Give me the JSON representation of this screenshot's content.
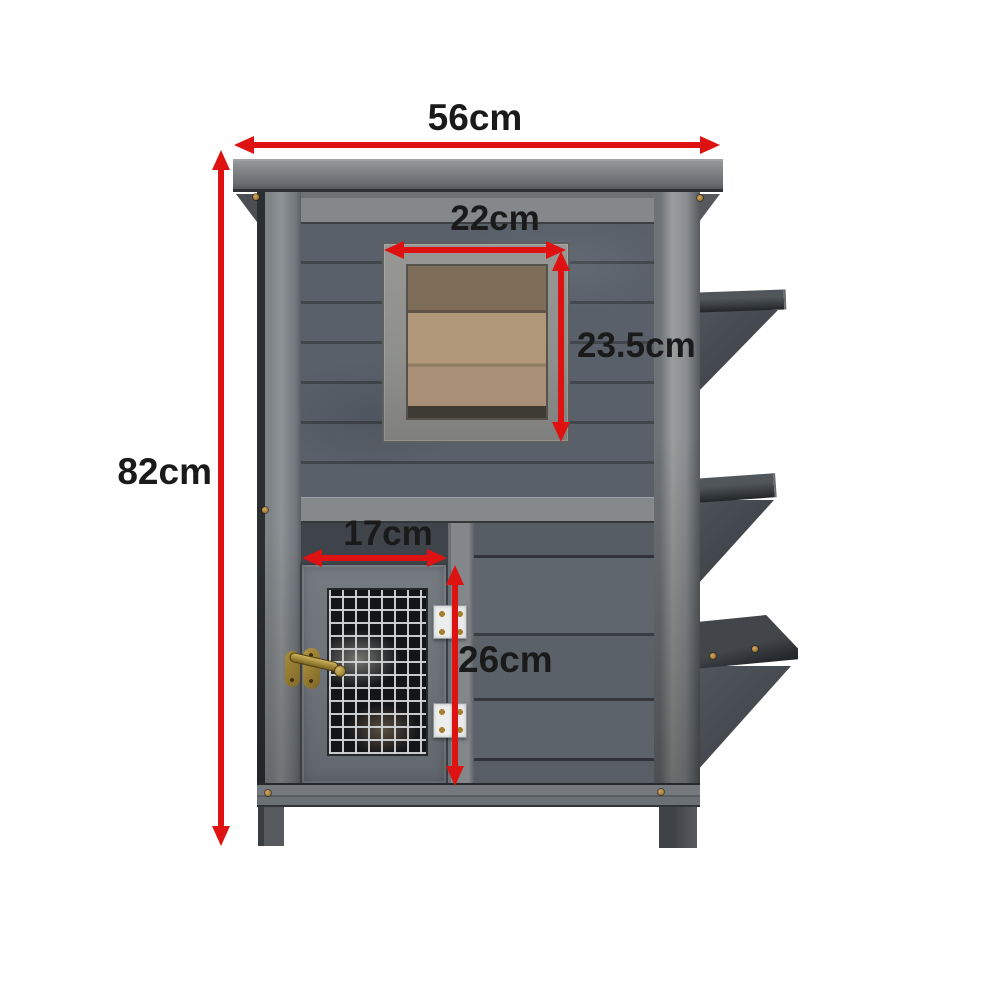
{
  "diagram": {
    "type": "product-dimension-diagram",
    "subject": "Two-storey grey wooden pet hutch with viewing window, wire mesh door and three side access steps",
    "unit": "cm",
    "arrow_color": "#df1212",
    "label_color": "#1a1a1a",
    "dimensions": [
      {
        "id": "overall-width",
        "label": "56cm",
        "value": 56,
        "orientation": "horizontal",
        "measures": "overall roof width"
      },
      {
        "id": "overall-height",
        "label": "82cm",
        "value": 82,
        "orientation": "vertical",
        "measures": "overall height"
      },
      {
        "id": "window-width",
        "label": "22cm",
        "value": 22,
        "orientation": "horizontal",
        "measures": "upper window width"
      },
      {
        "id": "window-height",
        "label": "23.5cm",
        "value": 23.5,
        "orientation": "vertical",
        "measures": "upper window height"
      },
      {
        "id": "door-width",
        "label": "17cm",
        "value": 17,
        "orientation": "horizontal",
        "measures": "lower mesh door width"
      },
      {
        "id": "door-height",
        "label": "26cm",
        "value": 26,
        "orientation": "vertical",
        "measures": "lower mesh door height"
      }
    ],
    "hutch_colors": {
      "roof": "#7b7f83",
      "frame_rails": "#85898c",
      "wall_planks": "#59606a",
      "window_wood": "#b2987a",
      "mesh_wire": "#d0d2d4",
      "mesh_background": "#141518",
      "hinge": "#eceded",
      "latch_brass": "#a3862f",
      "steps": "#42474d"
    }
  }
}
